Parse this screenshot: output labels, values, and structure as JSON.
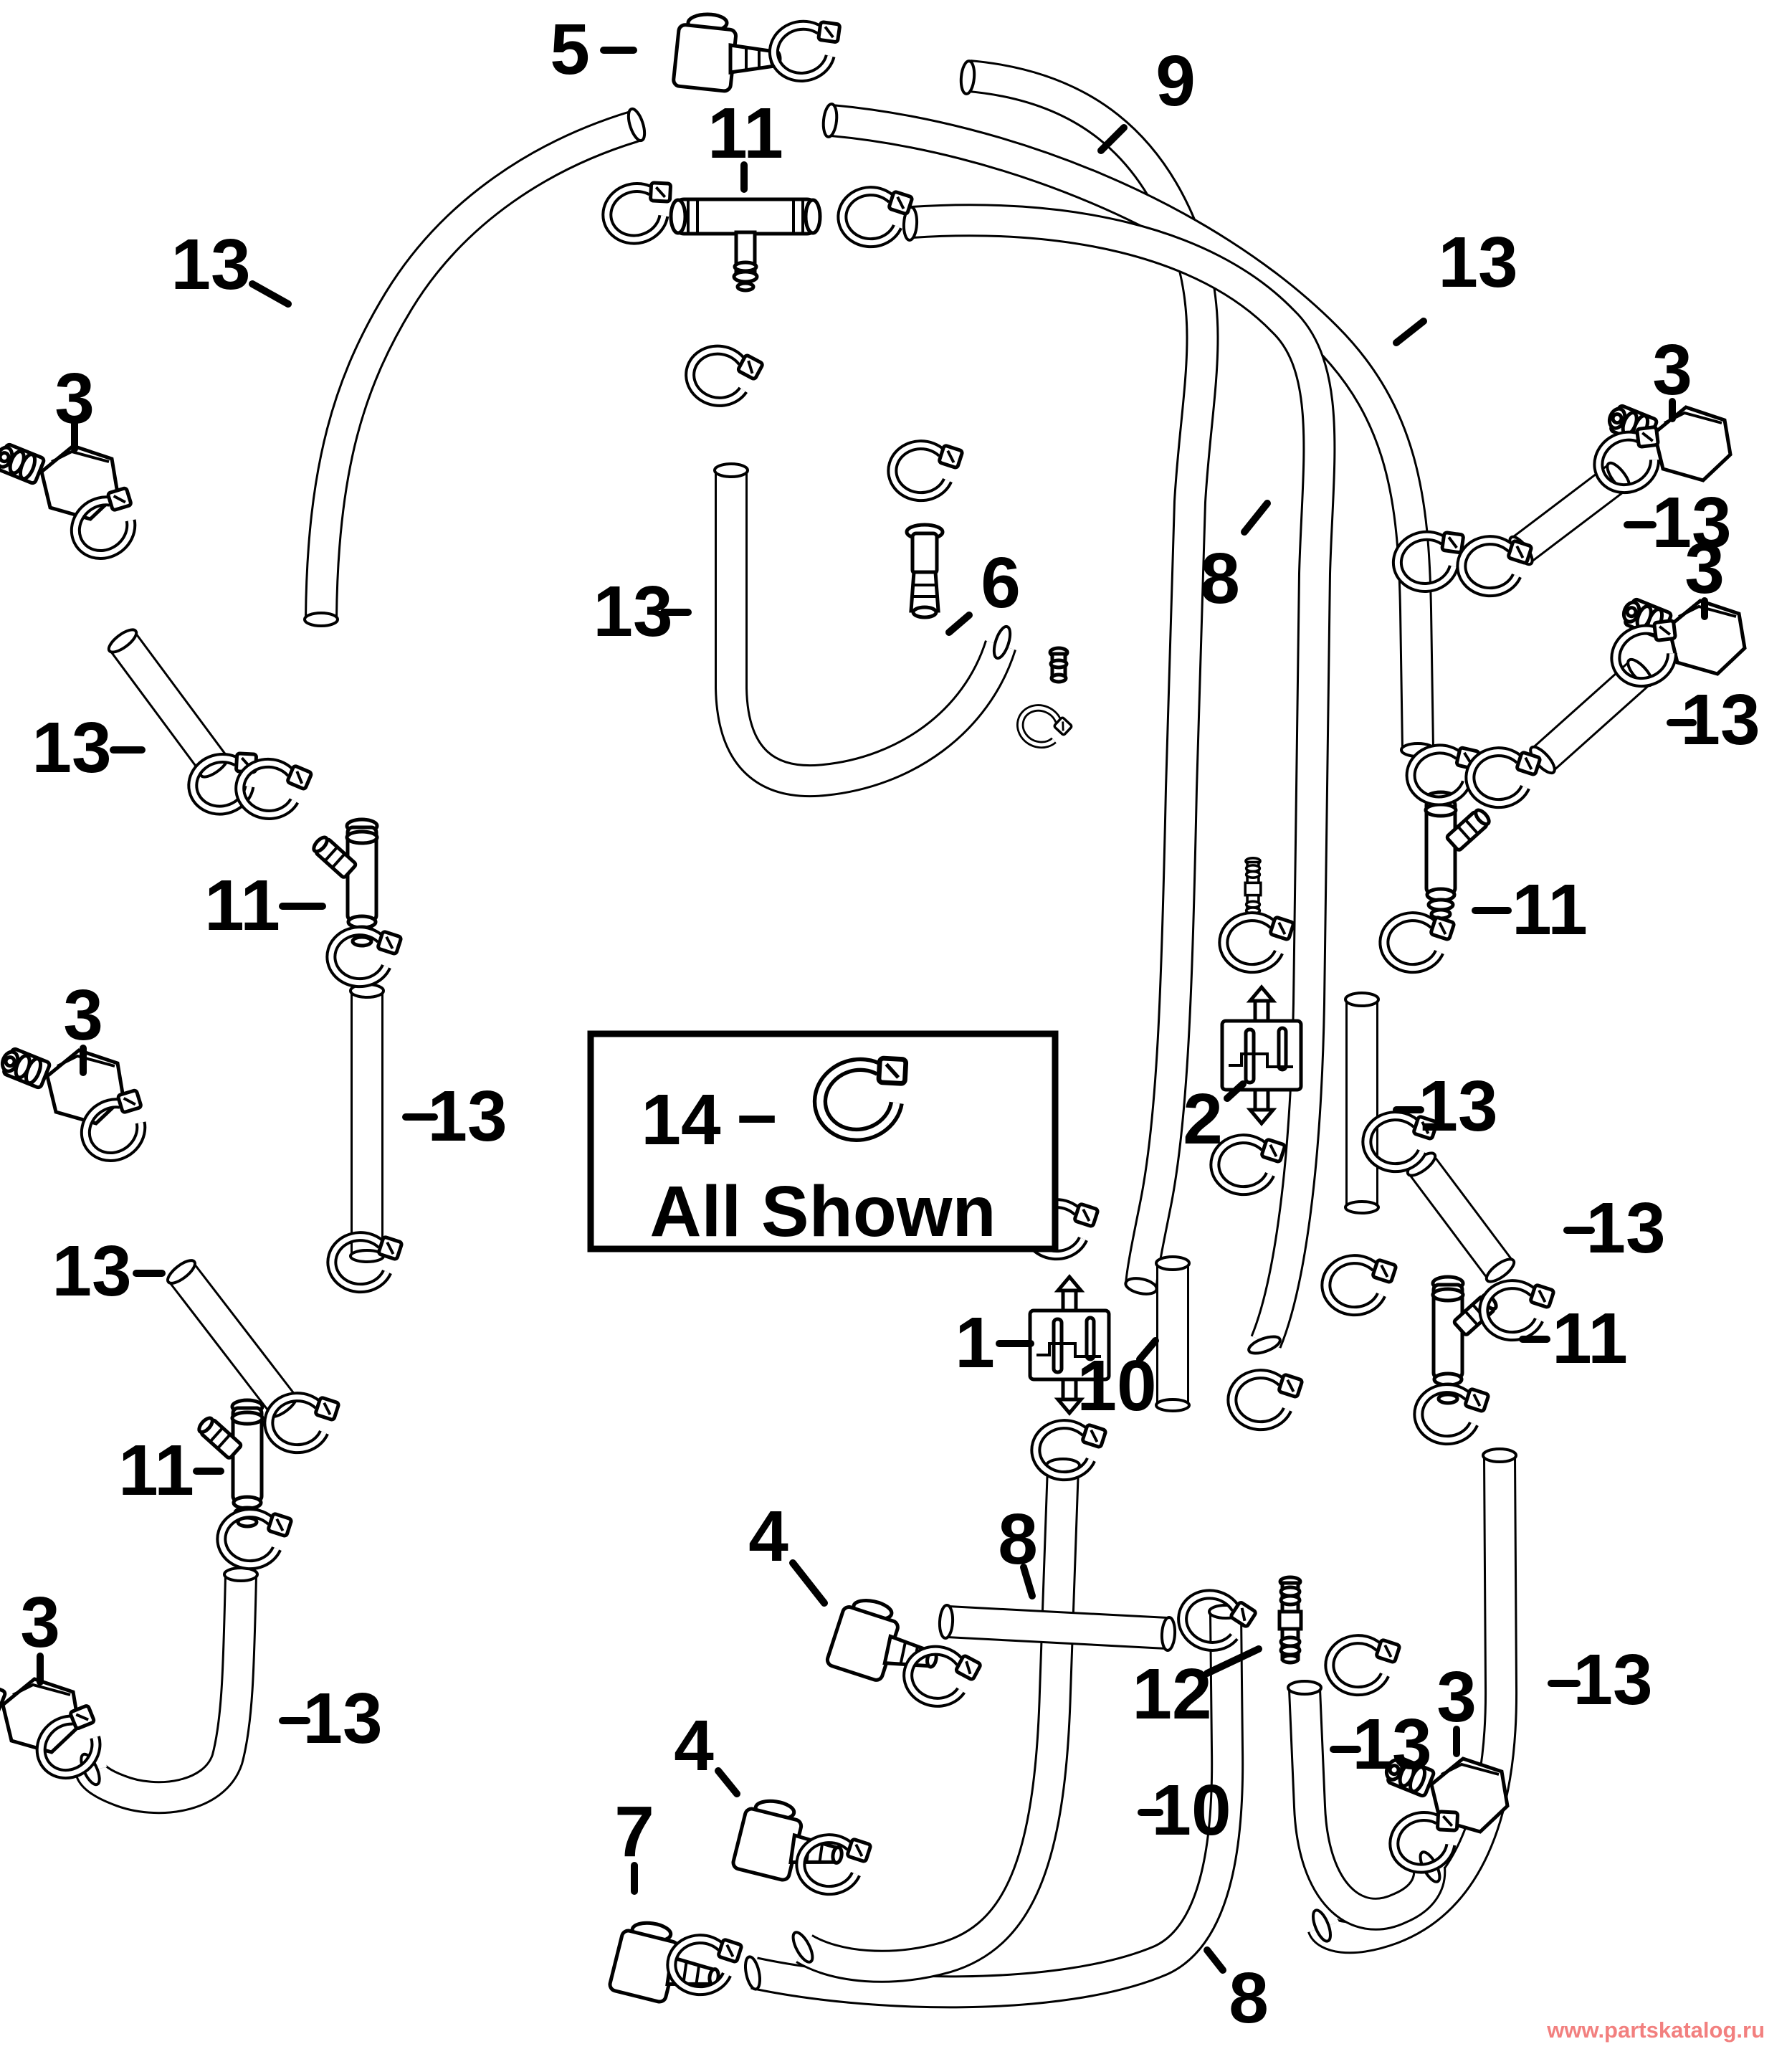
{
  "page": {
    "background": "#ffffff",
    "diagram_type": "exploded parts diagram",
    "subject": "fuel / vapor hose routing with clamps and fittings"
  },
  "note_box": {
    "part": "14",
    "separator": "–",
    "caption": "All Shown"
  },
  "watermark": {
    "text": "www.partskatalog.ru",
    "color": "#f2807f"
  },
  "callouts": [
    {
      "part": "5"
    },
    {
      "part": "11"
    },
    {
      "part": "13"
    },
    {
      "part": "9"
    },
    {
      "part": "13"
    },
    {
      "part": "3"
    },
    {
      "part": "13"
    },
    {
      "part": "11"
    },
    {
      "part": "13"
    },
    {
      "part": "3"
    },
    {
      "part": "13"
    },
    {
      "part": "11"
    },
    {
      "part": "13"
    },
    {
      "part": "3"
    },
    {
      "part": "13"
    },
    {
      "part": "6"
    },
    {
      "part": "8"
    },
    {
      "part": "13"
    },
    {
      "part": "3"
    },
    {
      "part": "3"
    },
    {
      "part": "13"
    },
    {
      "part": "11"
    },
    {
      "part": "13"
    },
    {
      "part": "2"
    },
    {
      "part": "13"
    },
    {
      "part": "11"
    },
    {
      "part": "1"
    },
    {
      "part": "10"
    },
    {
      "part": "4"
    },
    {
      "part": "8"
    },
    {
      "part": "12"
    },
    {
      "part": "10"
    },
    {
      "part": "13"
    },
    {
      "part": "13"
    },
    {
      "part": "3"
    },
    {
      "part": "4"
    },
    {
      "part": "7"
    },
    {
      "part": "8"
    }
  ]
}
